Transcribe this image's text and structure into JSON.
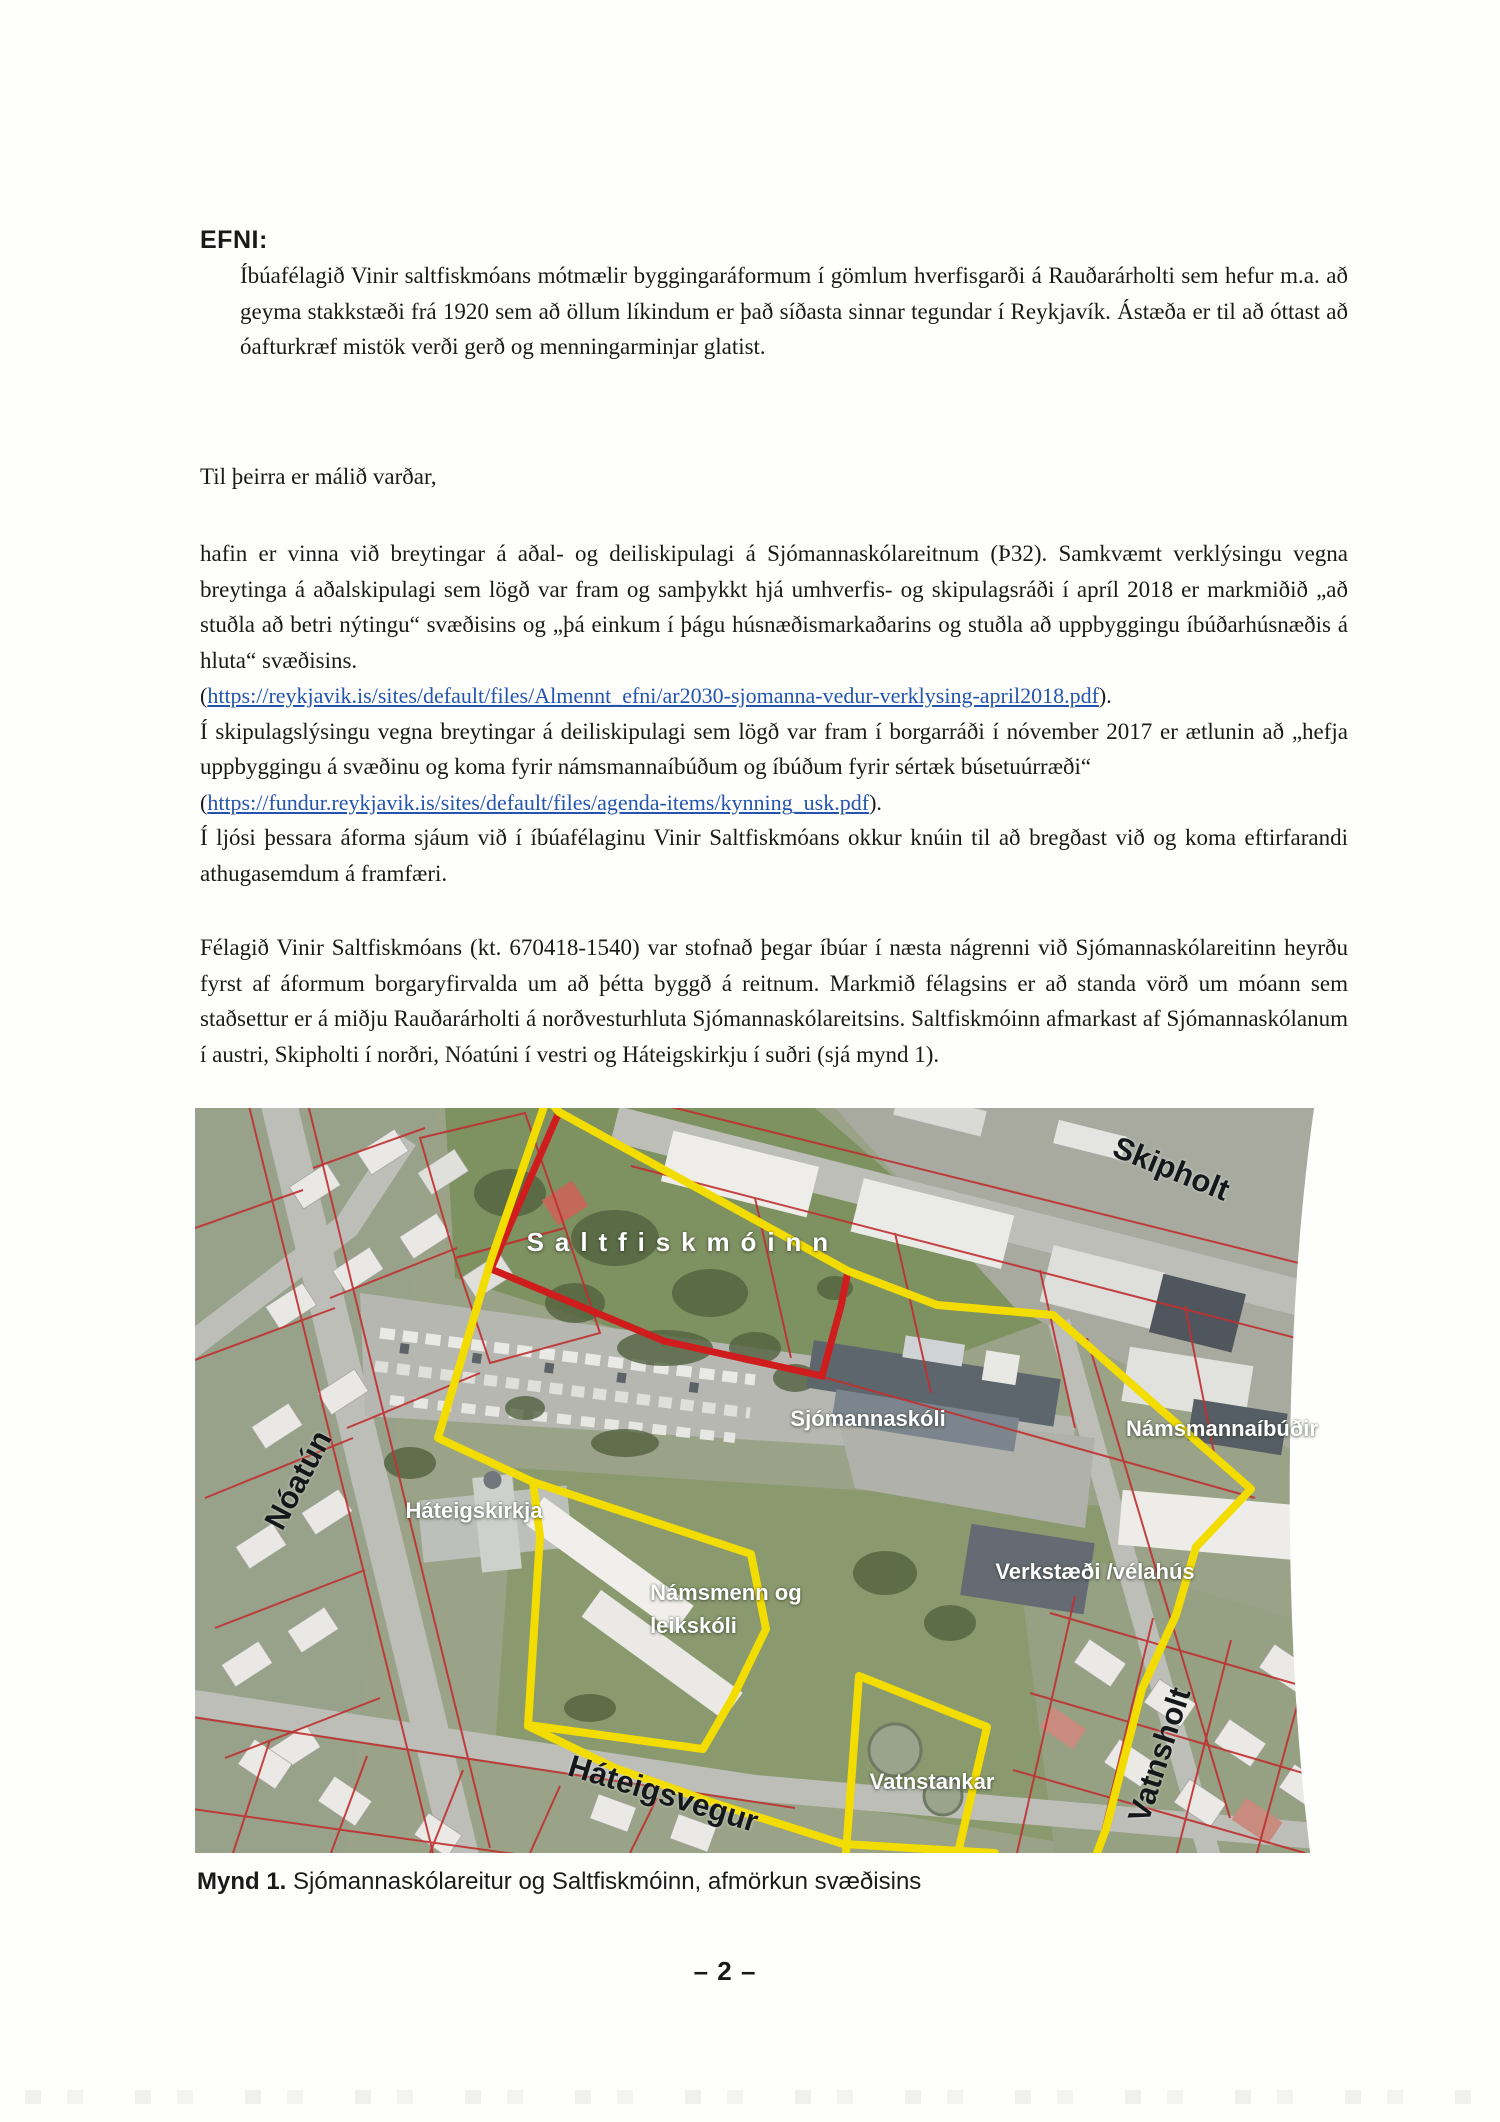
{
  "page": {
    "number_label": "– 2 –"
  },
  "letter": {
    "subject_label": "EFNI:",
    "subject_body": "Íbúafélagið Vinir saltfiskmóans mótmælir byggingaráformum í gömlum hverfisgarði á Rauðarárholti sem hefur m.a. að geyma stakkstæði frá 1920 sem að öllum líkindum er það síðasta sinnar tegundar í Reykjavík. Ástæða er til að óttast að óafturkræf mistök verði gerð og menningarminjar glatist.",
    "salutation": "Til þeirra er málið varðar,",
    "para_plans": "hafin er vinna við breytingar á aðal- og deiliskipulagi á Sjómannaskólareitnum (Þ32). Samkvæmt verklýsingu vegna breytinga á aðalskipulagi sem lögð var fram og samþykkt hjá umhverfis- og skipulagsráði í apríl 2018 er markmiðið „að stuðla að betri nýtingu“ svæðisins og „þá einkum í þágu húsnæðismarkaðarins og stuðla að uppbyggingu íbúðarhúsnæðis á hluta“ svæðisins.",
    "link_verklysing": {
      "prefix": "(",
      "url": "https://reykjavik.is/sites/default/files/Almennt_efni/ar2030-sjomanna-vedur-verklysing-april2018.pdf",
      "suffix": ")."
    },
    "para_deiliskipulag": "Í skipulagslýsingu vegna breytingar á deiliskipulagi sem lögð var fram í borgarráði í nóvember 2017 er ætlunin að „hefja uppbyggingu á svæðinu og koma fyrir námsmannaíbúðum og íbúðum fyrir sértæk búsetuúrræði“",
    "link_kynning": {
      "prefix": "(",
      "url": "https://fundur.reykjavik.is/sites/default/files/agenda-items/kynning_usk.pdf",
      "suffix": ")."
    },
    "para_response": "Í ljósi þessara áforma sjáum við í íbúafélaginu Vinir Saltfiskmóans okkur knúin til að bregðast við og koma eftirfarandi athugasemdum á framfæri.",
    "para_felagid": "Félagið Vinir Saltfiskmóans (kt. 670418-1540) var stofnað þegar íbúar í næsta nágrenni við Sjómannaskólareitinn heyrðu fyrst af áformum borgaryfirvalda um að þétta byggð á reitnum. Markmið félagsins er að standa vörð um móann sem staðsettur er á miðju Rauðarárholti á norðvesturhluta Sjómannaskólareitsins. Saltfiskmóinn afmarkast af Sjómannaskólanum í austri, Skipholti í norðri, Nóatúni í vestri og Háteigskirkju í suðri (sjá mynd 1)."
  },
  "figure": {
    "caption_label": "Mynd 1.",
    "caption_text": "Sjómannaskólareitur og Saltfiskmóinn, afmörkun svæðisins",
    "labels": {
      "saltfiskmoinn": "Saltfiskmóinn",
      "noatun": "Nóatún",
      "skipholt": "Skipholt",
      "namsmannaibudir": "Námsmannaíbúðir",
      "sjomannaskoli": "Sjómannaskóli",
      "hateigskirkja": "Háteigskirkja",
      "namsmenn_og_leikskoli_line1": "Námsmenn og",
      "namsmenn_og_leikskoli_line2": "leikskóli",
      "verkstaedi": "Verkstæði /vélahús",
      "vatnstankar": "Vatnstankar",
      "vatnsholt": "Vatnsholt",
      "hateigsvegur": "Háteigsvegur"
    },
    "colors": {
      "boundary_yellow": "#f3dc00",
      "saltfiskmoinn_red": "#cf1d1d",
      "parcel_red": "#bf3030",
      "link_blue": "#2355ae"
    }
  }
}
